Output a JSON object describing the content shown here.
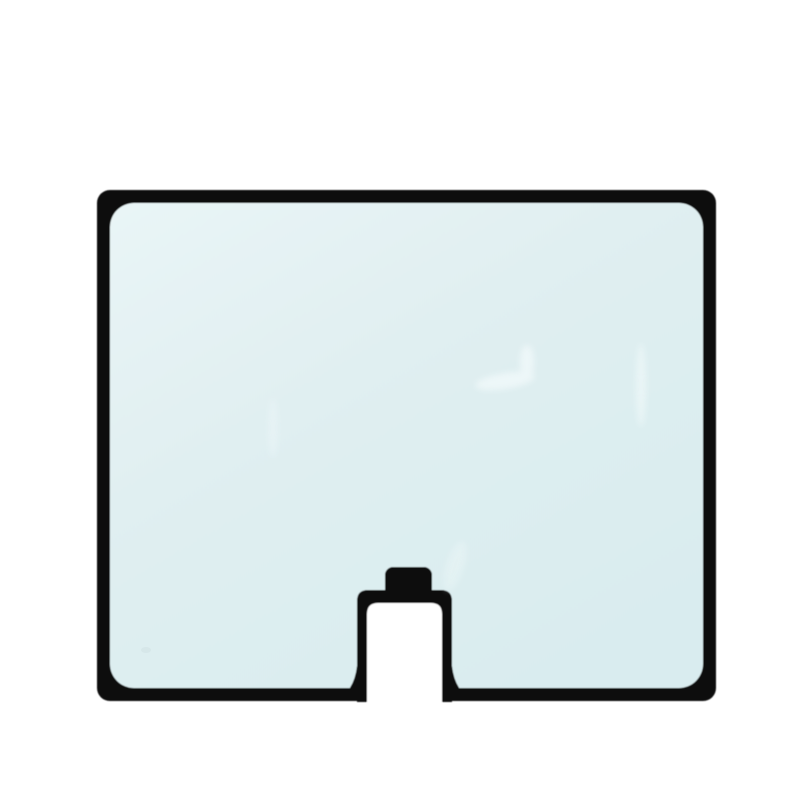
{
  "scene": {
    "object": "cab-window-glass-panel",
    "description": "Product photo of a tinted machinery cab window glass panel with a black rubber edge seal, rounded corners, and a bottom-center notch cutout with a small black mounting tab.",
    "background": "plain white"
  },
  "colors": {
    "background": "#ffffff",
    "seal": "#0b0b0b",
    "glass_light": "#e9f5f6",
    "glass_base": "#e0eff1",
    "glass_dark": "#d9ecef",
    "reflection": "#f6fcfd",
    "smudge": "#c9dadd"
  }
}
